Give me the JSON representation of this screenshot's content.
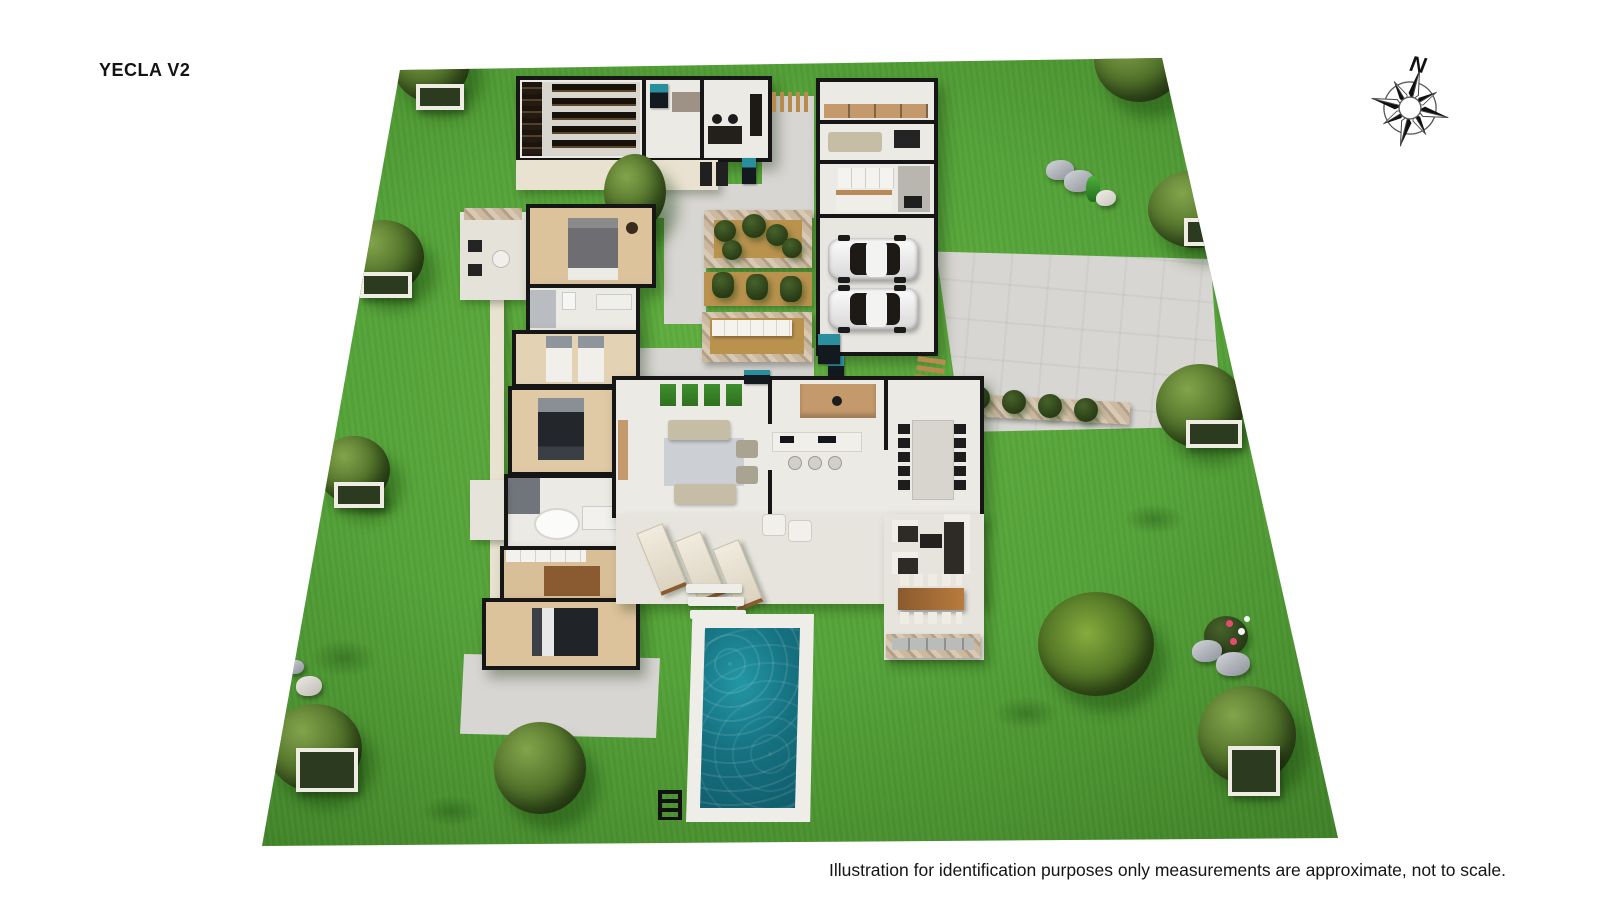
{
  "header": {
    "title": "YECLA V2"
  },
  "compass": {
    "north_label": "N"
  },
  "footer": {
    "disclaimer": "Illustration for identification purposes only measurements are approximate, not to scale."
  },
  "colors": {
    "grass": "#54a238",
    "grass_dark": "#3a7a24",
    "grass_light": "#62b040",
    "wall": "#161616",
    "floor": "#eceae4",
    "exterior_wall": "#e9e2d0",
    "path": "#d8d6d2",
    "driveway": "#d8d6d2",
    "wood": "#c49a6c",
    "wood_dark": "#8a5a2e",
    "stone": "#c4b299",
    "sand": "#b9924e",
    "pool_water": "#15707f",
    "pool_water_deep": "#0f5868",
    "pool_deck": "#efede8",
    "tree_green": "#4e7a28",
    "car_body": "#f2f2f2",
    "sofa": "#c6bda6",
    "furniture_dark": "#242424"
  }
}
